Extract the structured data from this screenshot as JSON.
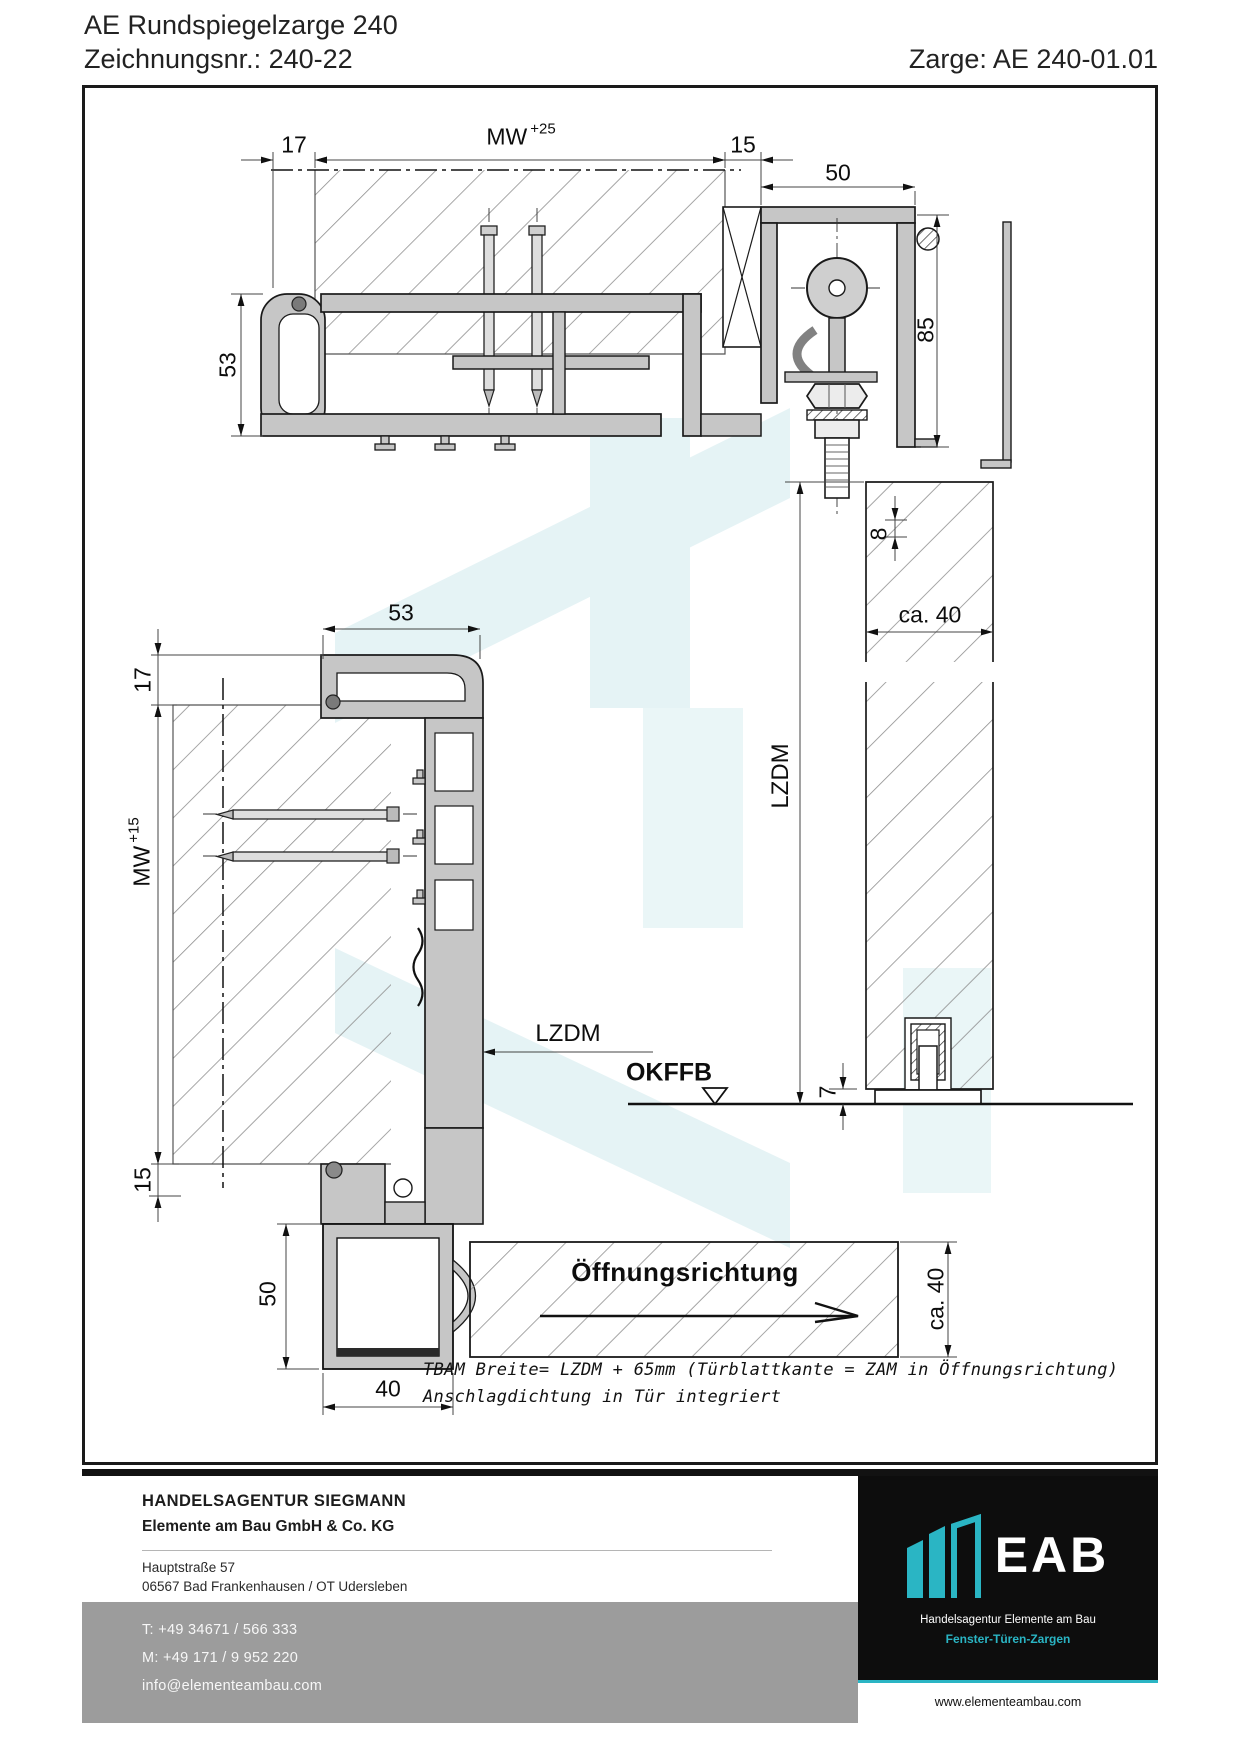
{
  "header": {
    "product": "AE Rundspiegelzarge 240",
    "drawing_no": "Zeichnungsnr.: 240-22",
    "frame_no": "Zarge: AE 240-01.01"
  },
  "drawing": {
    "dims": {
      "d17_head": "17",
      "mw": "MW",
      "mw_tol_head": "+25",
      "d15_head": "15",
      "d50_track": "50",
      "d85_track": "85",
      "d53_head": "53",
      "d8_gap": "8",
      "ca40_head": "ca. 40",
      "lzdm": "LZDM",
      "d53_jamb": "53",
      "d17_jamb": "17",
      "mw_tol_jamb": "+15",
      "d15_jamb": "15",
      "d50_jamb": "50",
      "d40_jamb": "40",
      "okffb": "OKFFB",
      "d7_floor": "7",
      "ca40_door": "ca. 40",
      "opening_direction": "Öffnungsrichtung"
    },
    "notes": [
      "TBAM Breite= LZDM + 65mm (Türblattkante = ZAM in Öffnungsrichtung)",
      "Anschlagdichtung in Tür integriert"
    ]
  },
  "footer": {
    "company_line1": "HANDELSAGENTUR SIEGMANN",
    "company_line2": "Elemente am Bau GmbH & Co. KG",
    "address_line1": "Hauptstraße 57",
    "address_line2": "06567 Bad Frankenhausen / OT Udersleben",
    "phone_t": "T: +49 34671 / 566 333",
    "phone_m": "M: +49 171 / 9 952 220",
    "email": "info@elementeambau.com",
    "logo": {
      "acronym": "EAB",
      "name": "Handelsagentur Elemente am Bau",
      "tagline": "Fenster-Türen-Zargen",
      "website": "www.elementeambau.com"
    },
    "colors": {
      "accent_teal": "#2ab5c4",
      "band_gray": "#9c9c9c",
      "logo_bg": "#0d0d0d",
      "profile_gray": "#c6c6c6"
    }
  }
}
